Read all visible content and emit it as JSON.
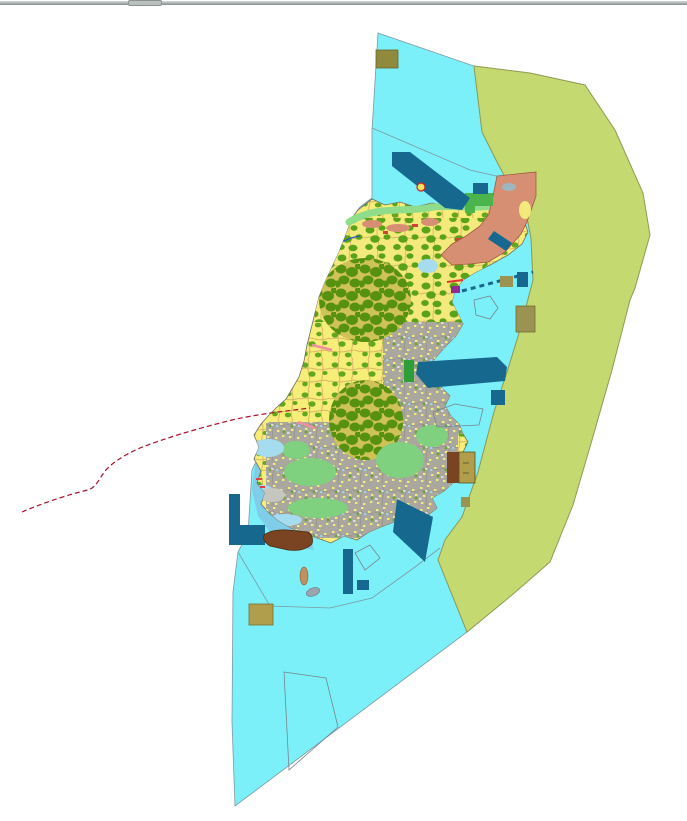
{
  "window": {
    "splitter": {
      "kind": "horizontal-splitter"
    }
  },
  "map": {
    "kind": "coastal land-use / zoning map canvas",
    "palette": {
      "background": "#ffffff",
      "sea": "#7cf0f8",
      "buffer_zone": "#c5d971",
      "salmon_zone": "#d78f74",
      "harbor_blue": "#16688f",
      "khaki_dark": "#8f8a3e",
      "khaki": "#9a9352",
      "khaki_light": "#b09e4c",
      "brown": "#7a4423",
      "farmland_yellow": "#f7ee79",
      "forest_green": "#62a81f",
      "urban_gray": "#aaa79e",
      "pale_green_coast": "#8fdc8a",
      "meadow_green": "#7fd07f",
      "pale_blue": "#a5dcf0",
      "intertidal_blue": "#7fcde9",
      "boundary_red": "#a9112a",
      "stream_blue": "#2255cc",
      "pink": "#ef8fa0",
      "purple": "#932a93",
      "bright_green": "#4cb44c"
    },
    "features": {
      "sea": "open-water-polygon",
      "buffer_zone": "offshore-buffer-strip",
      "island": "island-landmass-with-farmland-forest-urban",
      "salmon_zone": "northeast-development-zone",
      "harbor_works": "dark-blue-port-and-breakwater-structures",
      "boundary_line": "red-dashed-administrative-boundary",
      "parcels": "khaki-and-brown-designated-parcels",
      "survey_outlines": "unfilled-thin-outlined-polygons"
    }
  }
}
